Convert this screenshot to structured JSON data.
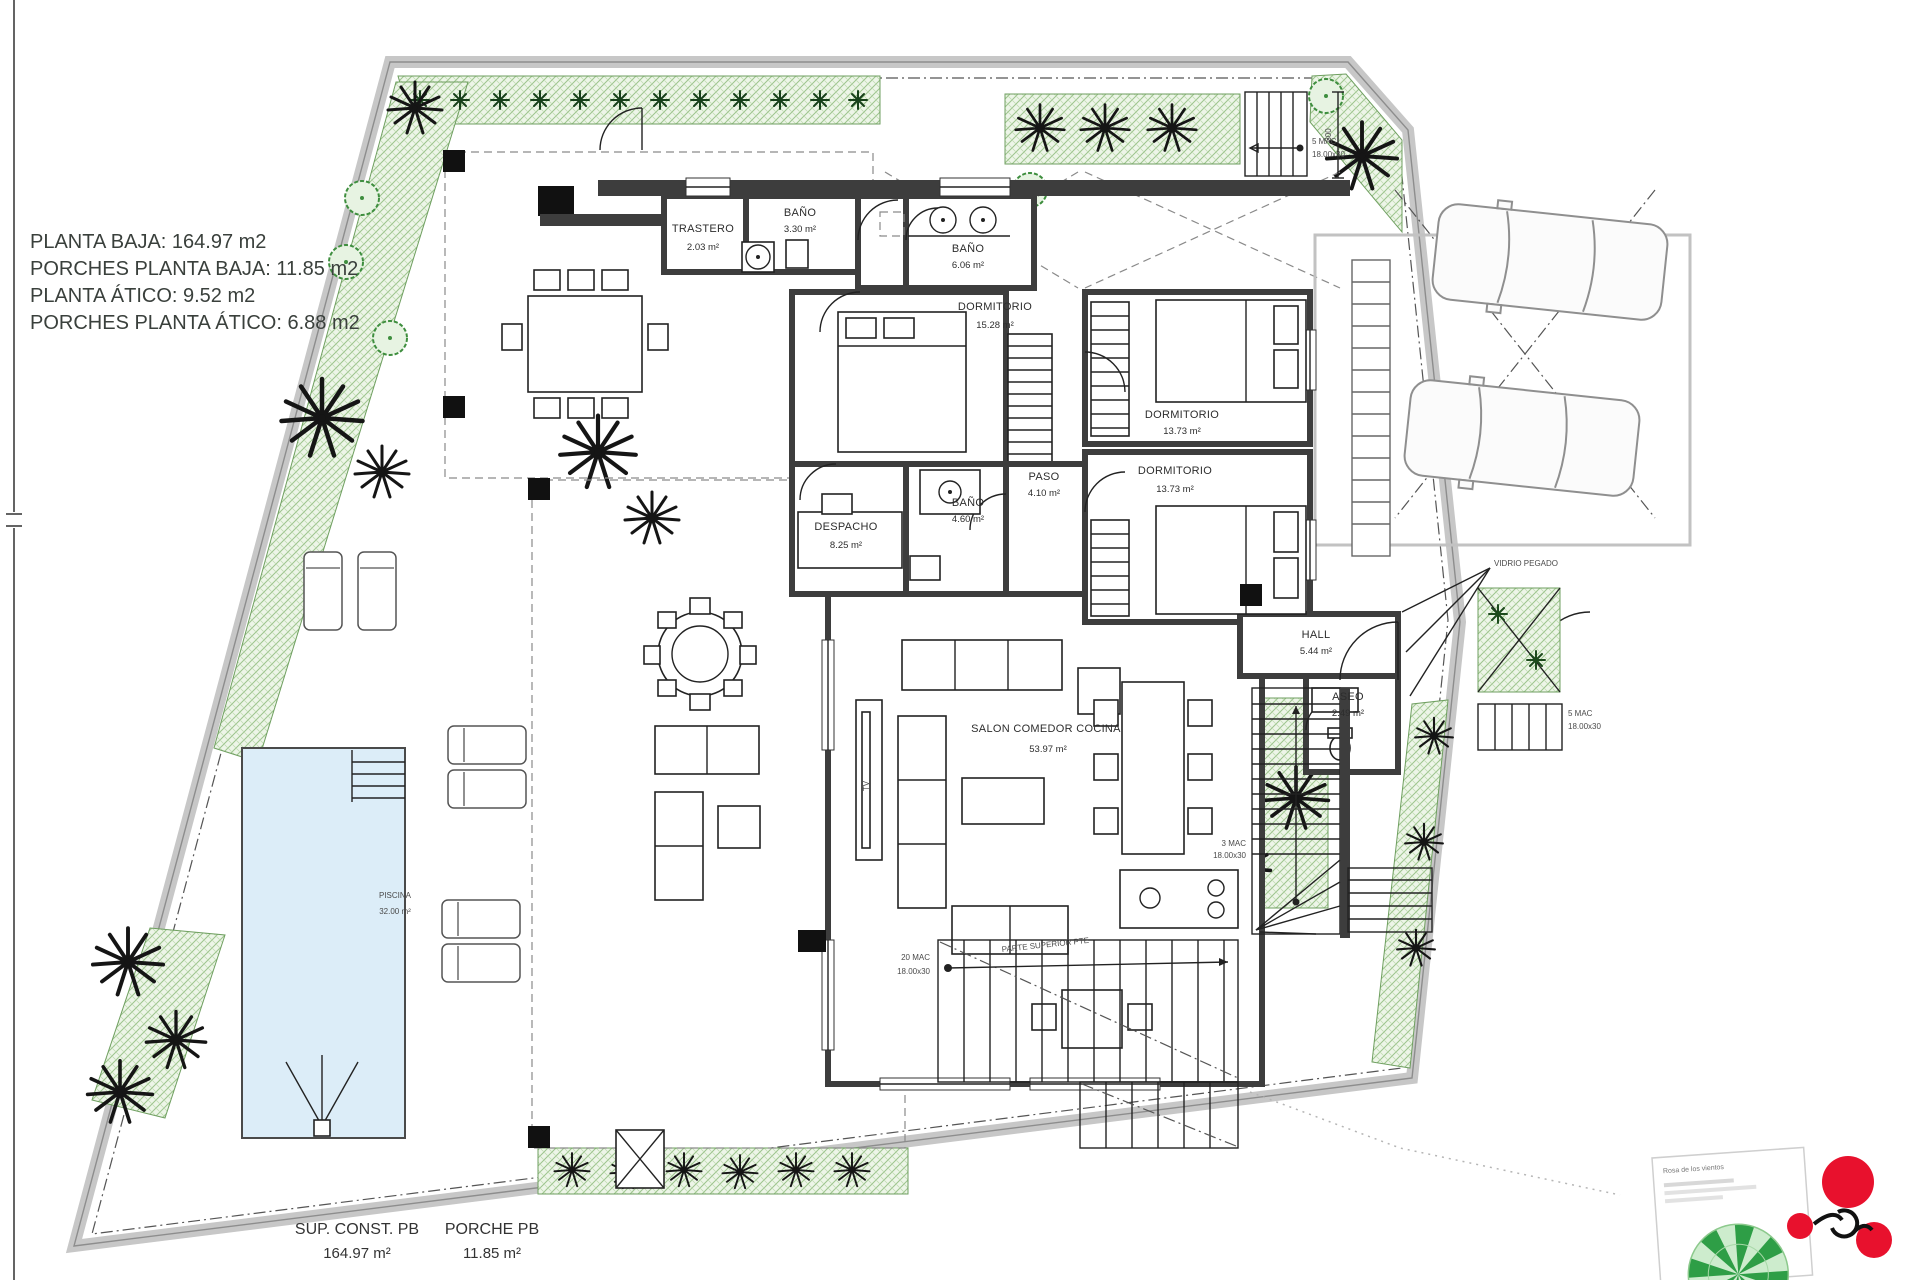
{
  "summary": {
    "lines": [
      "PLANTA BAJA: 164.97 m2",
      "PORCHES PLANTA BAJA: 11.85 m2",
      "PLANTA ÁTICO: 9.52 m2",
      "PORCHES PLANTA ÁTICO: 6.88 m2"
    ]
  },
  "rooms": {
    "trastero": {
      "name": "TRASTERO",
      "area": "2.03 m²"
    },
    "bano_top": {
      "name": "BAÑO",
      "area": "3.30 m²"
    },
    "bano_principal": {
      "name": "BAÑO",
      "area": "6.06 m²"
    },
    "dormitorio_principal": {
      "name": "DORMITORIO",
      "area": "15.28 m²"
    },
    "dormitorio_2": {
      "name": "DORMITORIO",
      "area": "13.73 m²"
    },
    "dormitorio_3": {
      "name": "DORMITORIO",
      "area": "13.73 m²"
    },
    "paso": {
      "name": "PASO",
      "area": "4.10 m²"
    },
    "bano_pasillo": {
      "name": "BAÑO",
      "area": "4.60 m²"
    },
    "despacho": {
      "name": "DESPACHO",
      "area": "8.25 m²"
    },
    "hall": {
      "name": "HALL",
      "area": "5.44 m²"
    },
    "aseo": {
      "name": "ASEO",
      "area": "2.49 m²"
    },
    "salon": {
      "name": "SALON COMEDOR COCINA",
      "area": "53.97 m²"
    }
  },
  "exterior": {
    "piscina": {
      "name": "PISCINA",
      "area": "32.00 m²"
    },
    "vidrio_pegado": "VIDRIO PEGADO",
    "tv": "TV"
  },
  "stairs": {
    "top": {
      "l1": "5 MAC",
      "l2": "18.00x30"
    },
    "main": {
      "l1": "20 MAC",
      "l2": "18.00x30"
    },
    "main_note": "PARTE SUPERIOR PTE",
    "interior": {
      "l1": "3 MAC",
      "l2": "18.00x30"
    },
    "entrance": {
      "l1": "5 MAC",
      "l2": "18.00x30"
    },
    "dim": "300"
  },
  "totals": {
    "sup_label": "SUP. CONST. PB",
    "sup_value": "164.97 m²",
    "porche_label": "PORCHE PB",
    "porche_value": "11.85 m²"
  },
  "legend": {
    "title": "Rosa de los vientos"
  },
  "colors": {
    "wall": "#3d3d3d",
    "garden": "#9cc48d",
    "pool": "#dcedf8",
    "accent_red": "#e8112d"
  }
}
